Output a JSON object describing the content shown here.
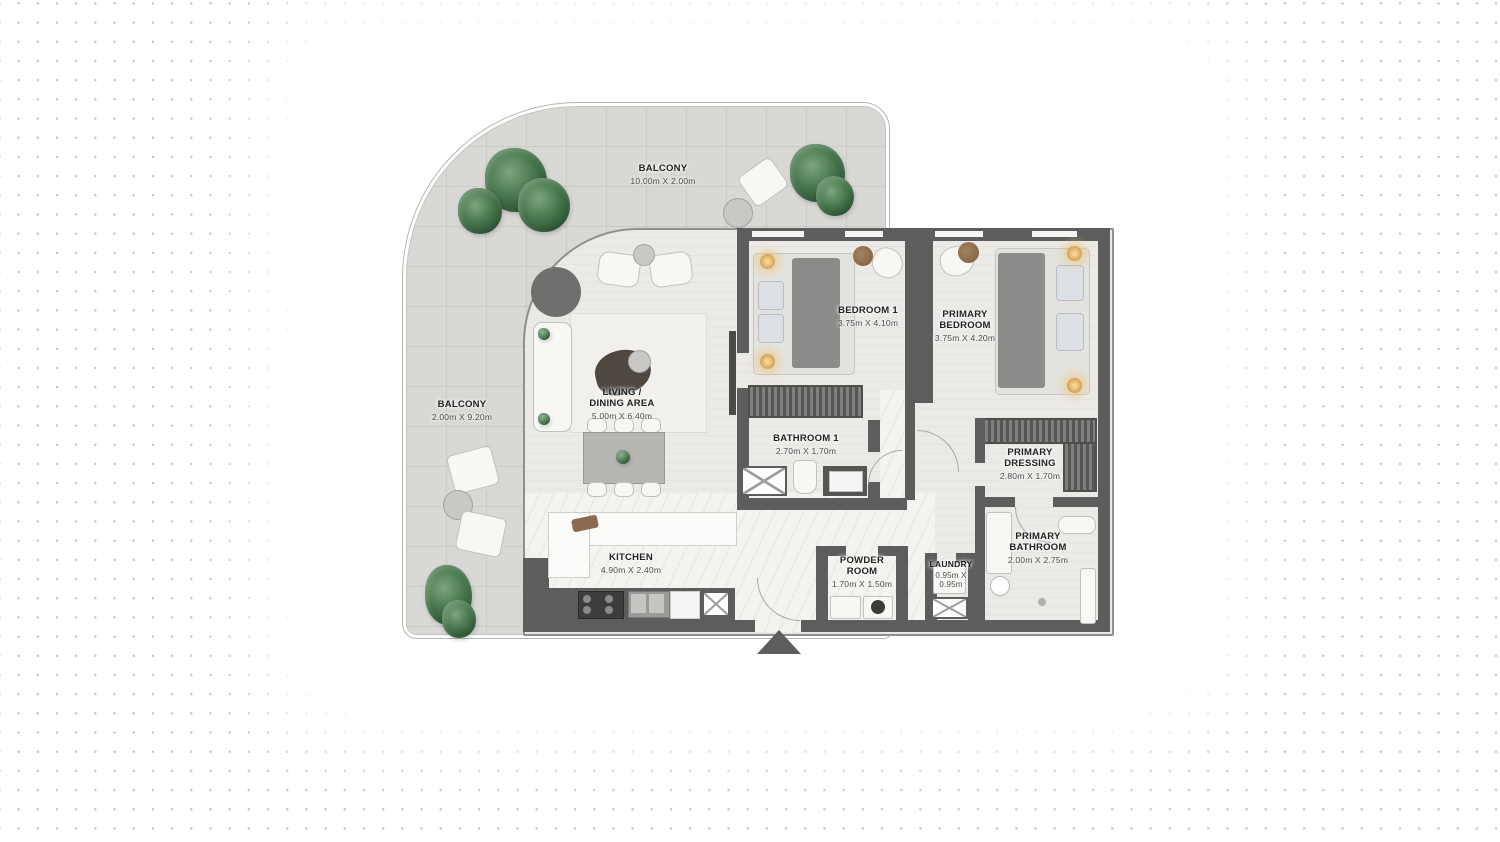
{
  "plan": {
    "type": "apartment-floor-plan",
    "colors": {
      "wall": "#5d5d5d",
      "balcony_floor": "#d9d8d4",
      "unit_floor": "#eceae7",
      "marble_floor": "#f4f3ef",
      "plant": "#3f6a47",
      "lamp_glow": "#e9b96e",
      "background_dot": "#c7c7c7"
    },
    "rooms": {
      "balcony_top": {
        "label": "BALCONY",
        "dims": "10.00m X 2.00m"
      },
      "balcony_left": {
        "label": "BALCONY",
        "dims": "2.00m X 9.20m"
      },
      "living_dining": {
        "label": "LIVING / DINING AREA",
        "dims": "5.00m X 6.40m"
      },
      "bedroom_1": {
        "label": "BEDROOM 1",
        "dims": "3.75m X 4.10m"
      },
      "primary_bedroom": {
        "label": "PRIMARY BEDROOM",
        "dims": "3.75m X 4.20m"
      },
      "bathroom_1": {
        "label": "BATHROOM 1",
        "dims": "2.70m X 1.70m"
      },
      "primary_dressing": {
        "label": "PRIMARY DRESSING",
        "dims": "2.80m X 1.70m"
      },
      "primary_bathroom": {
        "label": "PRIMARY BATHROOM",
        "dims": "2.00m X 2.75m"
      },
      "kitchen": {
        "label": "KITCHEN",
        "dims": "4.90m X 2.40m"
      },
      "powder_room": {
        "label": "POWDER ROOM",
        "dims": "1.70m X 1.50m"
      },
      "laundry": {
        "label": "LAUNDRY",
        "dims": "0.95m X 0.95m"
      }
    }
  }
}
